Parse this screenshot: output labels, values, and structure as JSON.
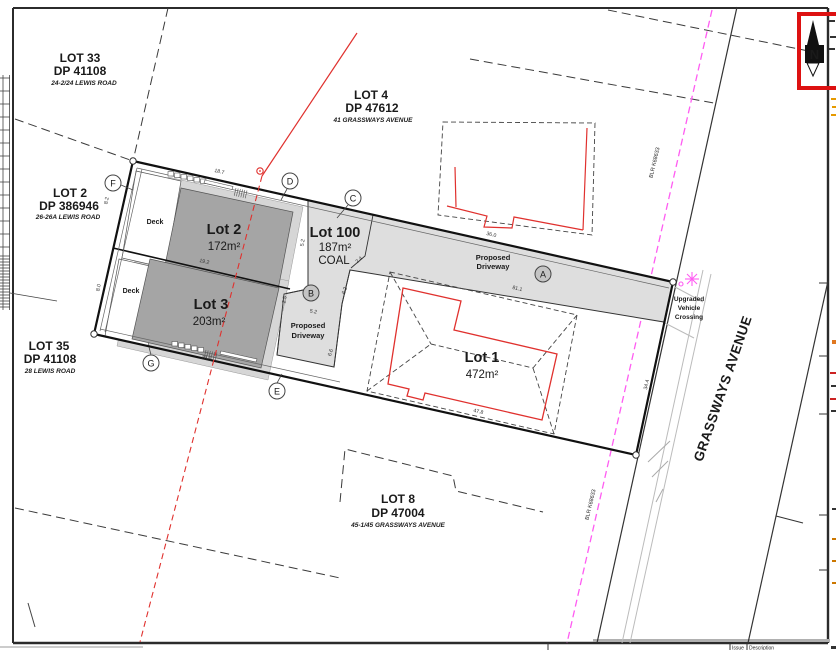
{
  "colors": {
    "red": "#e0312e",
    "magenta": "#ff5cf2",
    "dark_fill": "#a5a5a5",
    "light_fill": "#dedede",
    "line": "#1a1a1a",
    "highlight": "#dd1111"
  },
  "north": {
    "label": "N"
  },
  "parcels": {
    "lot33": {
      "name": "LOT 33",
      "dp": "DP 41108",
      "address": "24-2/24 LEWIS ROAD"
    },
    "lot2dp": {
      "name": "LOT 2",
      "dp": "DP 386946",
      "address": "26-26A LEWIS ROAD"
    },
    "lot4": {
      "name": "LOT 4",
      "dp": "DP 47612",
      "address": "41 GRASSWAYS AVENUE"
    },
    "lot35": {
      "name": "LOT 35",
      "dp": "DP 41108",
      "address": "28 LEWIS ROAD"
    },
    "lot8": {
      "name": "LOT 8",
      "dp": "DP 47004",
      "address": "45-1/45 GRASSWAYS AVENUE"
    }
  },
  "lots": {
    "lot2": {
      "name": "Lot 2",
      "area": "172m²"
    },
    "lot3": {
      "name": "Lot 3",
      "area": "203m²"
    },
    "lot100": {
      "name": "Lot 100",
      "area": "187m²",
      "tenure": "COAL"
    },
    "lot1": {
      "name": "Lot 1",
      "area": "472m²"
    }
  },
  "labels": {
    "deck1": "Deck",
    "deck2": "Deck",
    "driveway_main_1": "Proposed",
    "driveway_main_2": "Driveway",
    "driveway_small_1": "Proposed",
    "driveway_small_2": "Driveway",
    "crossing_1": "Upgraded",
    "crossing_2": "Vehicle",
    "crossing_3": "Crossing",
    "street": "GRASSWAYS AVENUE",
    "easement_1": "BLR K68633",
    "easement_2": "BLR K68633",
    "tb_issue": "Issue",
    "tb_description": "Description"
  },
  "markers": {
    "a": "A",
    "b": "B",
    "c": "C",
    "d": "D",
    "e": "E",
    "f": "F",
    "g": "G"
  },
  "dims": {
    "d1": "18.7",
    "d2": "19.2",
    "d3": "28.6",
    "d4": "8.2",
    "d5": "8.0",
    "d6": "5.2",
    "d7": "2.5",
    "d8": "5.2",
    "d9": "2.4",
    "d10": "6.2",
    "d11": "6.6",
    "d12": "36.0",
    "d13": "81.1",
    "d14": "47.8",
    "d15": "34.4"
  }
}
